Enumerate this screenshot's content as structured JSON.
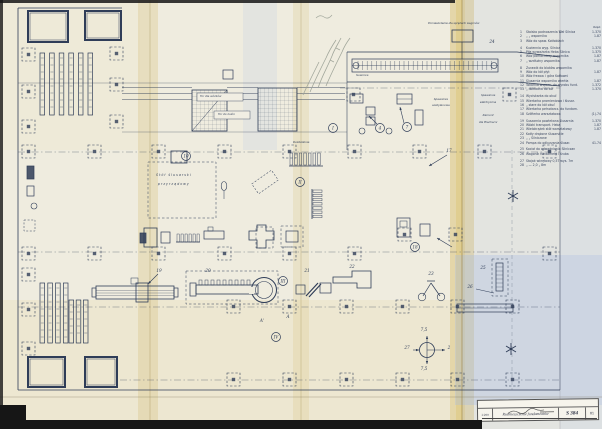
{
  "labels": {
    "top_box": "Pomieszczenie dla sprężarki wagonów",
    "corner_num": "24",
    "crane": "Suwnica",
    "switch_room": "Rozdzielnia",
    "track1": "Tor dla wózków",
    "track2": "Tor do kuźni",
    "bench1": "Stół  ślusarski",
    "bench2": "przyrządowy",
    "weld1a": "Spawalnia",
    "weld1b": "acetylenowa",
    "weld2a": "Spawalnia",
    "weld2b": "elektryczna",
    "weld2c": "Remont",
    "weld2d": "dla Blacharni"
  },
  "legend": {
    "header": "Rzęd.",
    "items": [
      {
        "no": "1",
        "text": "Stoisko podnoszenia Wał Silnica",
        "code": "1-370",
        "gap": false
      },
      {
        "no": "2",
        "text": "  „      „      wspornika",
        "code": "1-87",
        "gap": false
      },
      {
        "no": "3",
        "text": "Wóz do spaw. Kotłoblach",
        "code": "",
        "gap": false
      },
      {
        "no": "4",
        "text": "Kuziennia wyg. Silnica",
        "code": "1-370",
        "gap": true
      },
      {
        "no": "5",
        "text": "Piła wyważarka Heba Silnica",
        "code": "1-375",
        "gap": false
      },
      {
        "no": "6",
        "text": "Wóz pomocniczy wspornika",
        "code": "1-87",
        "gap": false
      },
      {
        "no": "7",
        "text": "  „  wzdłużny wspornika",
        "code": "1-87",
        "gap": false
      },
      {
        "no": "8",
        "text": "Żurawik do bloków wspornika",
        "code": "",
        "gap": true
      },
      {
        "no": "9",
        "text": "Wóz do kół płyt",
        "code": "1-87",
        "gap": false
      },
      {
        "no": "10",
        "text": "Wóz frezow. i góra Kotłowni",
        "code": "",
        "gap": false
      },
      {
        "no": "11",
        "text": "Ślusarnia wspornika wiertła",
        "code": "1-87",
        "gap": false
      },
      {
        "no": "12",
        "text": "Tokarnia wsporn. do wyrobu fund.",
        "code": "1-372",
        "gap": false
      },
      {
        "no": "13",
        "text": "  „   dokładna do kół",
        "code": "1-370",
        "gap": false
      },
      {
        "no": "14",
        "text": "Wyciskarka do okuć",
        "code": "",
        "gap": true
      },
      {
        "no": "15",
        "text": "Wiertarka promieniowa i ślusar.",
        "code": "",
        "gap": false
      },
      {
        "no": "16",
        "text": "  „   stare do kół okuć",
        "code": "",
        "gap": false
      },
      {
        "no": "17",
        "text": "Wiertarka pełnotarcz. do fundam.",
        "code": "",
        "gap": false
      },
      {
        "no": "18",
        "text": "Szlifierka warsztatowa",
        "code": "(1)-74",
        "gap": false
      },
      {
        "no": "19",
        "text": "Suszarnia powlekana ślusarnia",
        "code": "1-370",
        "gap": true
      },
      {
        "no": "20",
        "text": "Wózki transport. Heba",
        "code": "1-87",
        "gap": false
      },
      {
        "no": "21",
        "text": "Wielokrążek stół warsztatowy",
        "code": "1-87",
        "gap": false
      },
      {
        "no": "22",
        "text": "Kotły drążone ślusarskie",
        "code": "",
        "gap": false
      },
      {
        "no": "23",
        "text": "  „      „   Silniczane",
        "code": "",
        "gap": false
      },
      {
        "no": "24",
        "text": "Pompa do odkurzania ślusar.",
        "code": "41-74",
        "gap": false
      },
      {
        "no": "25",
        "text": "Kocioł do odwadniania Silniczan",
        "code": "",
        "gap": true
      },
      {
        "no": "26",
        "text": "Wagonik fundament i śruba",
        "code": "",
        "gap": false
      },
      {
        "no": "27",
        "text": "Stojak wkrętowy 0,5T  wys. 7m",
        "code": "",
        "gap": true
      },
      {
        "no": "28",
        "text": "  „   —   2,0   „   8m",
        "code": "",
        "gap": false
      }
    ]
  },
  "title_block": {
    "scale": "1:200",
    "title": "Rozmieszczenie fundamentów",
    "drawing_no": "S 384",
    "sheet": "81"
  },
  "markers": {
    "circled": [
      {
        "label": "I",
        "x": 333,
        "y": 128
      },
      {
        "label": "II",
        "x": 300,
        "y": 182
      },
      {
        "label": "III",
        "x": 283,
        "y": 281
      },
      {
        "label": "IV",
        "x": 276,
        "y": 337
      },
      {
        "label": "4",
        "x": 380,
        "y": 128
      },
      {
        "label": "7",
        "x": 407,
        "y": 127
      },
      {
        "label": "10",
        "x": 186,
        "y": 156
      },
      {
        "label": "18",
        "x": 415,
        "y": 247
      }
    ],
    "plain": [
      {
        "label": "24",
        "x": 492,
        "y": 43
      },
      {
        "label": "19",
        "x": 159,
        "y": 272
      },
      {
        "label": "20",
        "x": 208,
        "y": 272
      },
      {
        "label": "21",
        "x": 307,
        "y": 272
      },
      {
        "label": "22",
        "x": 352,
        "y": 268
      },
      {
        "label": "23",
        "x": 431,
        "y": 275
      },
      {
        "label": "25",
        "x": 483,
        "y": 269
      },
      {
        "label": "26",
        "x": 470,
        "y": 288
      },
      {
        "label": "27",
        "x": 407,
        "y": 349
      },
      {
        "label": "2",
        "x": 449,
        "y": 349
      },
      {
        "label": "7,5",
        "x": 424,
        "y": 331
      },
      {
        "label": "7,5",
        "x": 424,
        "y": 370
      },
      {
        "label": "17",
        "x": 449,
        "y": 152
      },
      {
        "label": "A",
        "x": 288,
        "y": 318
      },
      {
        "label": "A'",
        "x": 262,
        "y": 322
      }
    ]
  },
  "grid": {
    "squares": [
      [
        22,
        48
      ],
      [
        22,
        85
      ],
      [
        22,
        120
      ],
      [
        110,
        47
      ],
      [
        110,
        78
      ],
      [
        110,
        115
      ],
      [
        22,
        145
      ],
      [
        88,
        145
      ],
      [
        152,
        145
      ],
      [
        218,
        145
      ],
      [
        283,
        145
      ],
      [
        348,
        145
      ],
      [
        413,
        145
      ],
      [
        478,
        145
      ],
      [
        543,
        145
      ],
      [
        22,
        247
      ],
      [
        88,
        247
      ],
      [
        152,
        247
      ],
      [
        218,
        247
      ],
      [
        283,
        247
      ],
      [
        348,
        247
      ],
      [
        543,
        247
      ],
      [
        398,
        228
      ],
      [
        449,
        228
      ],
      [
        22,
        268
      ],
      [
        22,
        303
      ],
      [
        22,
        342
      ],
      [
        227,
        300
      ],
      [
        283,
        300
      ],
      [
        340,
        300
      ],
      [
        396,
        300
      ],
      [
        451,
        300
      ],
      [
        506,
        300
      ],
      [
        227,
        373
      ],
      [
        283,
        373
      ],
      [
        340,
        373
      ],
      [
        396,
        373
      ],
      [
        451,
        373
      ],
      [
        506,
        373
      ],
      [
        347,
        88
      ],
      [
        503,
        88
      ]
    ]
  }
}
